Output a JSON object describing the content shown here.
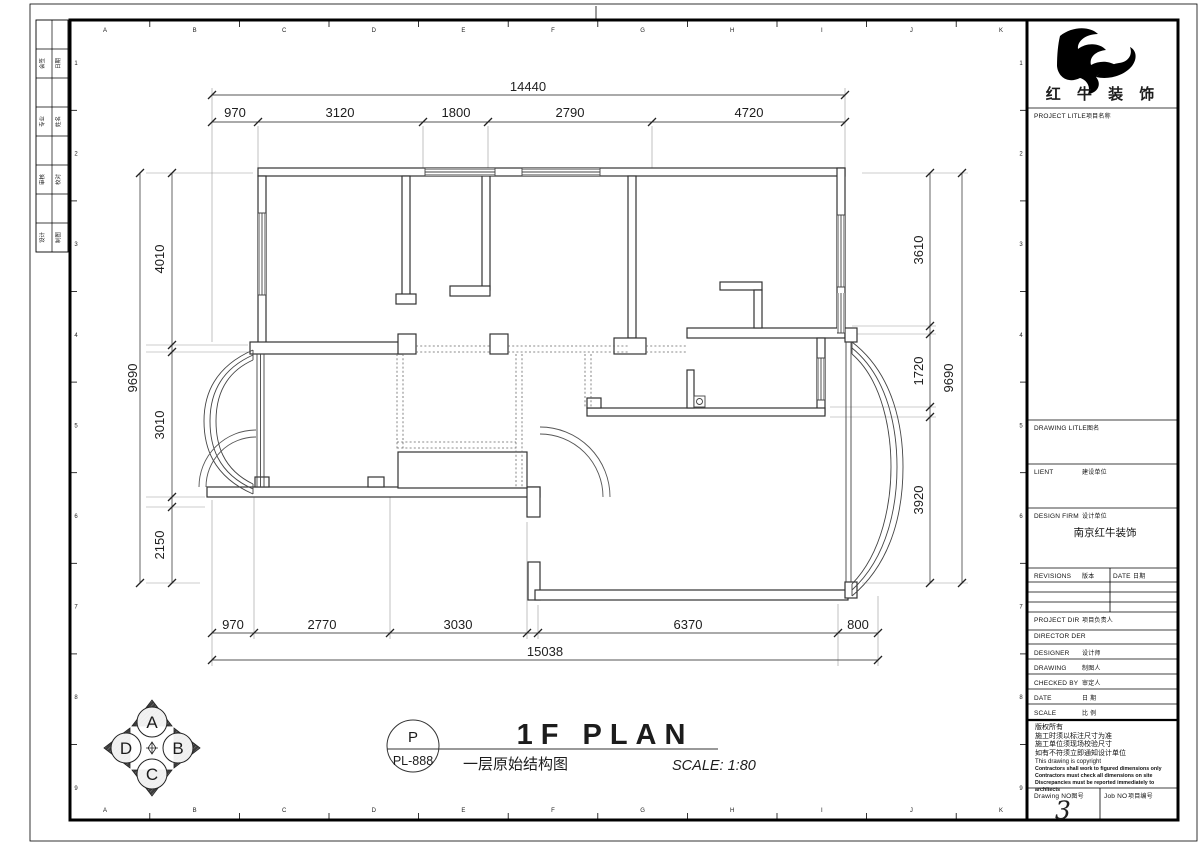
{
  "sheet": {
    "grid_letters": [
      "A",
      "B",
      "C",
      "D",
      "E",
      "F",
      "G",
      "H",
      "I",
      "J",
      "K"
    ],
    "grid_numbers": [
      "1",
      "2",
      "3",
      "4",
      "5",
      "6",
      "7",
      "8",
      "9"
    ],
    "binding_strip": [
      {
        "left": "会签",
        "right": "日期"
      },
      {
        "left": "专业",
        "right": "姓名"
      },
      {
        "left": "审核",
        "right": "校对"
      },
      {
        "left": "设计",
        "right": "制图"
      }
    ]
  },
  "plan": {
    "name": "1F PLAN",
    "caption_zh": "一层原始结构图",
    "scale_text": "SCALE: 1:80",
    "stamp": {
      "letter": "P",
      "code": "PL-888"
    },
    "compass": {
      "top": "A",
      "right": "B",
      "bottom": "C",
      "left": "D"
    },
    "dimensions": {
      "top": {
        "total": "14440",
        "segments": [
          "970",
          "3120",
          "1800",
          "2790",
          "4720"
        ]
      },
      "bottom": {
        "total": "15038",
        "segments": [
          "970",
          "2770",
          "3030",
          "6370",
          "800"
        ]
      },
      "left": {
        "total": "9690",
        "segments": [
          "4010",
          "3010",
          "2150"
        ]
      },
      "right": {
        "total": "9690",
        "segments": [
          "3610",
          "1720",
          "3920"
        ]
      }
    }
  },
  "title_block": {
    "brand": "红 牛 装 饰",
    "project_title_en": "PROJECT LITLE",
    "project_title_zh": "项目名称",
    "drawing_title_en": "DRAWING LITLE",
    "drawing_title_zh": "图名",
    "client_en": "LIENT",
    "client_zh": "建设单位",
    "design_firm_en": "DESIGN FIRM",
    "design_firm_zh": "设计单位",
    "design_firm_value": "南京红牛装饰",
    "revisions_en": "REVISIONS",
    "revisions_zh": "版本",
    "revisions_date_en": "DATE",
    "revisions_date_zh": "日期",
    "project_dir_en": "PROJECT DIR",
    "project_dir_zh": "项目负责人",
    "director_en": "DIRECTOR DER",
    "director_zh": "",
    "designer_en": "DESIGNER",
    "designer_zh": "设计师",
    "drawing_by_en": "DRAWING",
    "drawing_by_zh": "制图人",
    "checked_by_en": "CHECKED BY",
    "checked_by_zh": "审定人",
    "date_en": "DATE",
    "date_zh": "日 期",
    "scale_en": "SCALE",
    "scale_zh": "比 例",
    "notice_lines": [
      "版权所有",
      "施工时须以标注尺寸为准",
      "施工单位须现场校验尺寸",
      "如有不符须立即通知设计单位",
      "This drawing is copyright"
    ],
    "notice_bold_lines": [
      "Contractors shall work to figured dimensions only",
      "Contractors must check all dimensions on site",
      "Discrepancies must be reported immediately to architects"
    ],
    "drawing_no_en": "Drawing NO",
    "drawing_no_zh": "图号",
    "drawing_no_value": "3",
    "job_no_en": "Job NO",
    "job_no_zh": "项目编号",
    "job_no_value": ""
  }
}
